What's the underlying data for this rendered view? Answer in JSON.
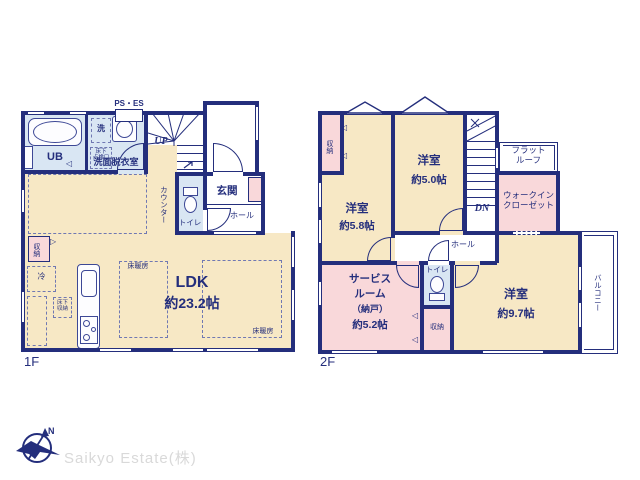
{
  "colors": {
    "wall": "#242e7c",
    "cream": "#f7e8c5",
    "pink": "#f9d8da",
    "blue": "#d9e6f3",
    "logo_gray": "#d9d9d9"
  },
  "icons": {
    "door_fold_left": "◁",
    "door_fold_right": "▷"
  },
  "floor1": {
    "floor_label": "1F",
    "ps_es": "PS・ES",
    "ub": "UB",
    "washroom": "洗面脱衣室",
    "washer": "洗",
    "hatch_l1": "床下",
    "hatch_l2": "点検口",
    "up": "UP",
    "counter": "カウンター",
    "genkan": "玄関",
    "hall": "ホール",
    "toilet": "トイレ",
    "storage": "収納",
    "fridge": "冷",
    "underfloor_l1": "床下",
    "underfloor_l2": "収納",
    "floor_heating": "床暖房",
    "ldk": "LDK",
    "ldk_size": "約23.2帖"
  },
  "floor2": {
    "floor_label": "2F",
    "storage_left": "収納",
    "bed58": "洋室",
    "bed58_size": "約5.8帖",
    "bed50": "洋室",
    "bed50_size": "約5.0帖",
    "dn": "DN",
    "flat_roof_l1": "フラット",
    "flat_roof_l2": "ルーフ",
    "wic_l1": "ウォークイン",
    "wic_l2": "クローゼット",
    "hall": "ホール",
    "toilet": "トイレ",
    "storage_bottom": "収納",
    "service_l1": "サービス",
    "service_l2": "ルーム",
    "service_l3": "（納戸）",
    "service_l4": "約5.2帖",
    "bed97": "洋室",
    "bed97_size": "約9.7帖",
    "balcony": "バルコニー"
  },
  "footer": {
    "company": "Saikyo Estate(株)",
    "north": "N"
  }
}
